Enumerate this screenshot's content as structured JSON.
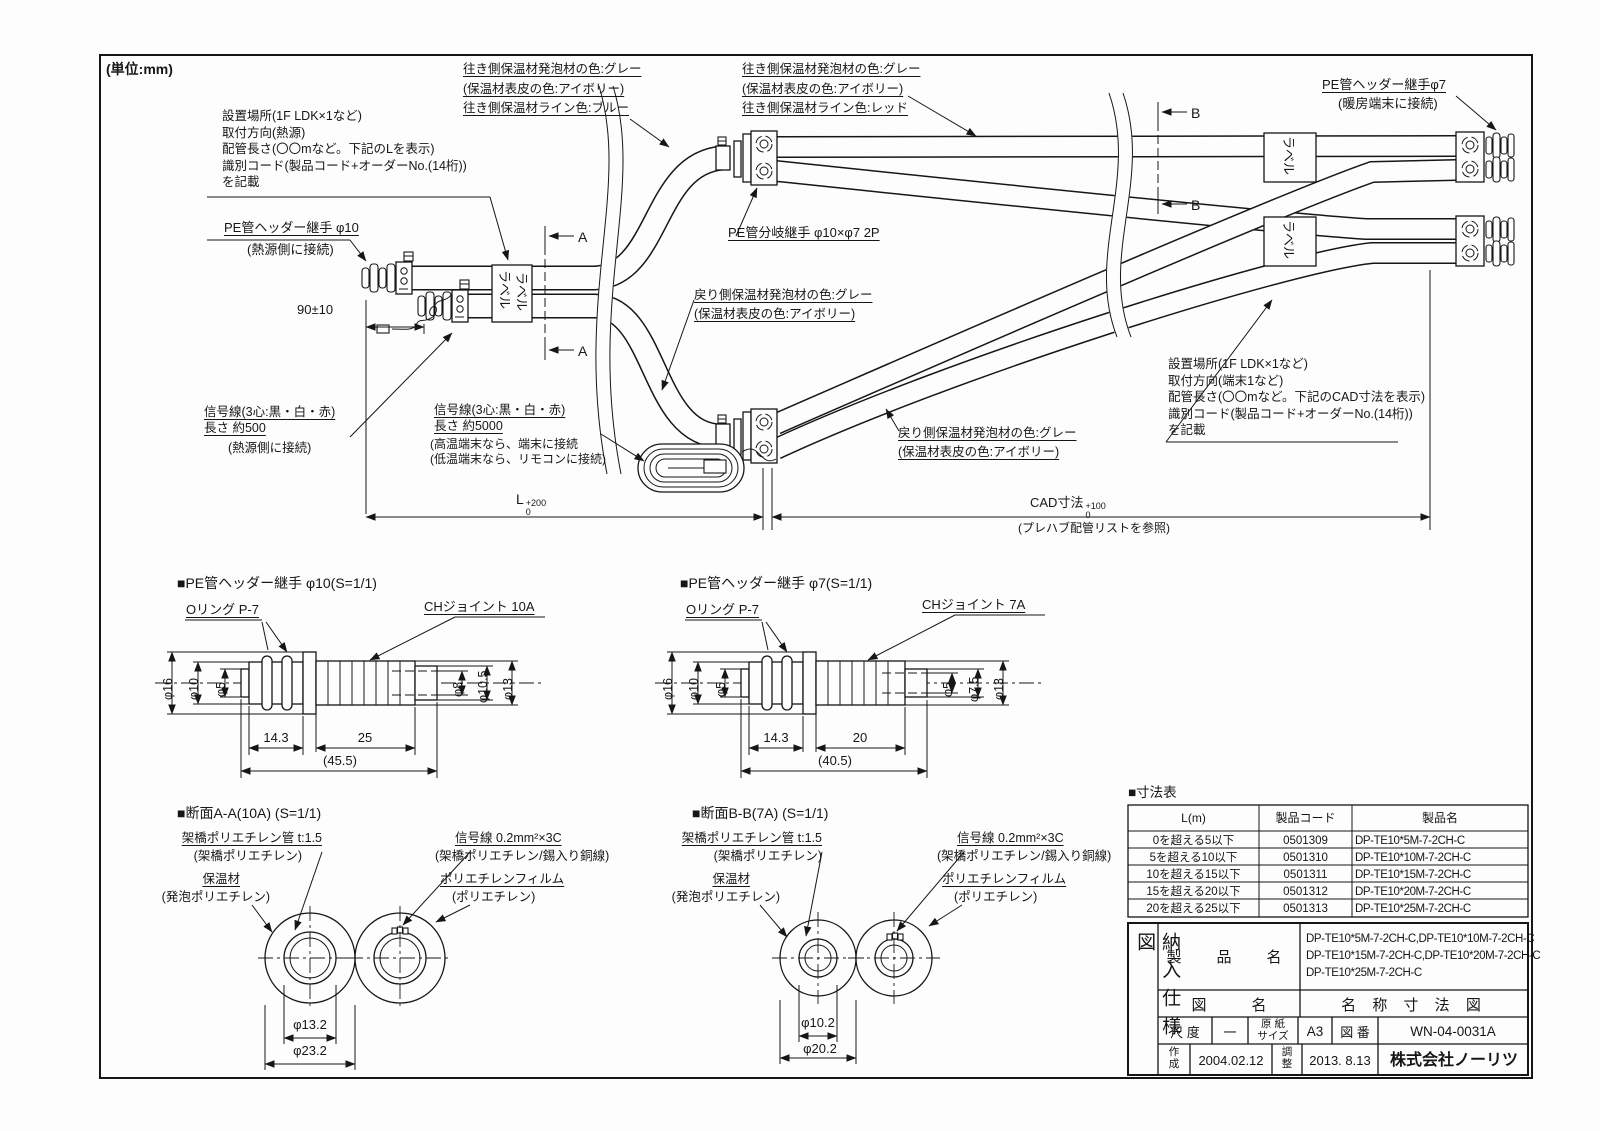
{
  "unit": "(単位:mm)",
  "main": {
    "install_left": "設置場所(1F LDK×1など)\n取付方向(熱源)\n配管長さ(〇〇mなど。下記のLを表示)\n識別コード(製品コード+オーダーNo.(14桁))\nを記載",
    "header10": "PE管ヘッダー継手 φ10",
    "header10_sub": "(熱源側に接続)",
    "dim_90": "90±10",
    "supply_left": "往き側保温材発泡材の色:グレー\n(保温材表皮の色:アイボリー)\n往き側保温材ライン色:ブルー",
    "supply_right": "往き側保温材発泡材の色:グレー\n(保温材表皮の色:アイボリー)\n往き側保温材ライン色:レッド",
    "header7": "PE管ヘッダー継手φ7",
    "header7_sub": "(暖房端末に接続)",
    "branch": "PE管分岐継手 φ10×φ7 2P",
    "return_mid": "戻り側保温材発泡材の色:グレー\n(保温材表皮の色:アイボリー)",
    "return_right": "戻り側保温材発泡材の色:グレー\n(保温材表皮の色:アイボリー)",
    "signal_left": "信号線(3心:黒・白・赤)\n長さ 約500",
    "signal_left_sub": "(熱源側に接続)",
    "signal_mid": "信号線(3心:黒・白・赤)\n長さ 約5000",
    "signal_mid_sub": "(高温端末なら、端末に接続\n(低温端末なら、リモコンに接続)",
    "install_right": "設置場所(1F LDK×1など)\n取付方向(端末1など)\n配管長さ(〇〇mなど。下記のCAD寸法を表示)\n識別コード(製品コード+オーダーNo.(14桁))\nを記載",
    "dim_l": "L",
    "dim_l_up": "+200",
    "dim_l_dn": "0",
    "dim_cad": "CAD寸法",
    "dim_cad_up": "+100",
    "dim_cad_dn": "0",
    "cad_note": "(プレハブ配管リストを参照)",
    "label_tag": "ラベル",
    "sec_a": "A",
    "sec_b": "B"
  },
  "detail10": {
    "title": "■PE管ヘッダー継手 φ10(S=1/1)",
    "oring": "Oリング P-7",
    "joint": "CHジョイント 10A",
    "d16": "φ16",
    "d10": "φ10",
    "d5": "φ5",
    "d8": "φ8",
    "d105": "φ10.5",
    "d13": "φ13",
    "w1": "14.3",
    "w2": "25",
    "wt": "(45.5)"
  },
  "detail7": {
    "title": "■PE管ヘッダー継手 φ7(S=1/1)",
    "oring": "Oリング P-7",
    "joint": "CHジョイント 7A",
    "d16": "φ16",
    "d10": "φ10",
    "d5a": "φ5",
    "d5b": "φ5",
    "d75": "φ7.5",
    "d13": "φ13",
    "w1": "14.3",
    "w2": "20",
    "wt": "(40.5)"
  },
  "secA": {
    "title": "■断面A-A(10A) (S=1/1)",
    "pipe": "架橋ポリエチレン管 t:1.5",
    "pipe_sub": "(架橋ポリエチレン)",
    "insul": "保温材",
    "insul_sub": "(発泡ポリエチレン)",
    "signal": "信号線 0.2mm²×3C",
    "signal_sub": "(架橋ポリエチレン/錫入り銅線)",
    "film": "ポリエチレンフィルム",
    "film_sub": "(ポリエチレン)",
    "d1": "φ13.2",
    "d2": "φ23.2"
  },
  "secB": {
    "title": "■断面B-B(7A) (S=1/1)",
    "pipe": "架橋ポリエチレン管 t:1.5",
    "pipe_sub": "(架橋ポリエチレン)",
    "insul": "保温材",
    "insul_sub": "(発泡ポリエチレン)",
    "signal": "信号線 0.2mm²×3C",
    "signal_sub": "(架橋ポリエチレン/錫入り銅線)",
    "film": "ポリエチレンフィルム",
    "film_sub": "(ポリエチレン)",
    "d1": "φ10.2",
    "d2": "φ20.2"
  },
  "size_table": {
    "title": "■寸法表",
    "headers": [
      "L(m)",
      "製品コード",
      "製品名"
    ],
    "rows": [
      [
        "0を超える5以下",
        "0501309",
        "DP-TE10*5M-7-2CH-C"
      ],
      [
        "5を超える10以下",
        "0501310",
        "DP-TE10*10M-7-2CH-C"
      ],
      [
        "10を超える15以下",
        "0501311",
        "DP-TE10*15M-7-2CH-C"
      ],
      [
        "15を超える20以下",
        "0501312",
        "DP-TE10*20M-7-2CH-C"
      ],
      [
        "20を超える25以下",
        "0501313",
        "DP-TE10*25M-7-2CH-C"
      ]
    ]
  },
  "title_block": {
    "doc_type": "納入仕様図",
    "product_label": "製　品　名",
    "products": "DP-TE10*5M-7-2CH-C,DP-TE10*10M-7-2CH-C\nDP-TE10*15M-7-2CH-C,DP-TE10*20M-7-2CH-C\nDP-TE10*25M-7-2CH-C",
    "drawing_label": "図　　　名",
    "drawing_name": "名 称 寸 法 図",
    "scale_label": "尺 度",
    "scale": "一",
    "paper_label": "原 紙\nサイズ",
    "paper": "A3",
    "no_label": "図 番",
    "no": "WN-04-0031A",
    "created_label": "作\n成",
    "created": "2004.02.12",
    "adjusted_label": "調\n整",
    "adjusted": "2013. 8.13",
    "company": "株式会社ノーリツ"
  }
}
